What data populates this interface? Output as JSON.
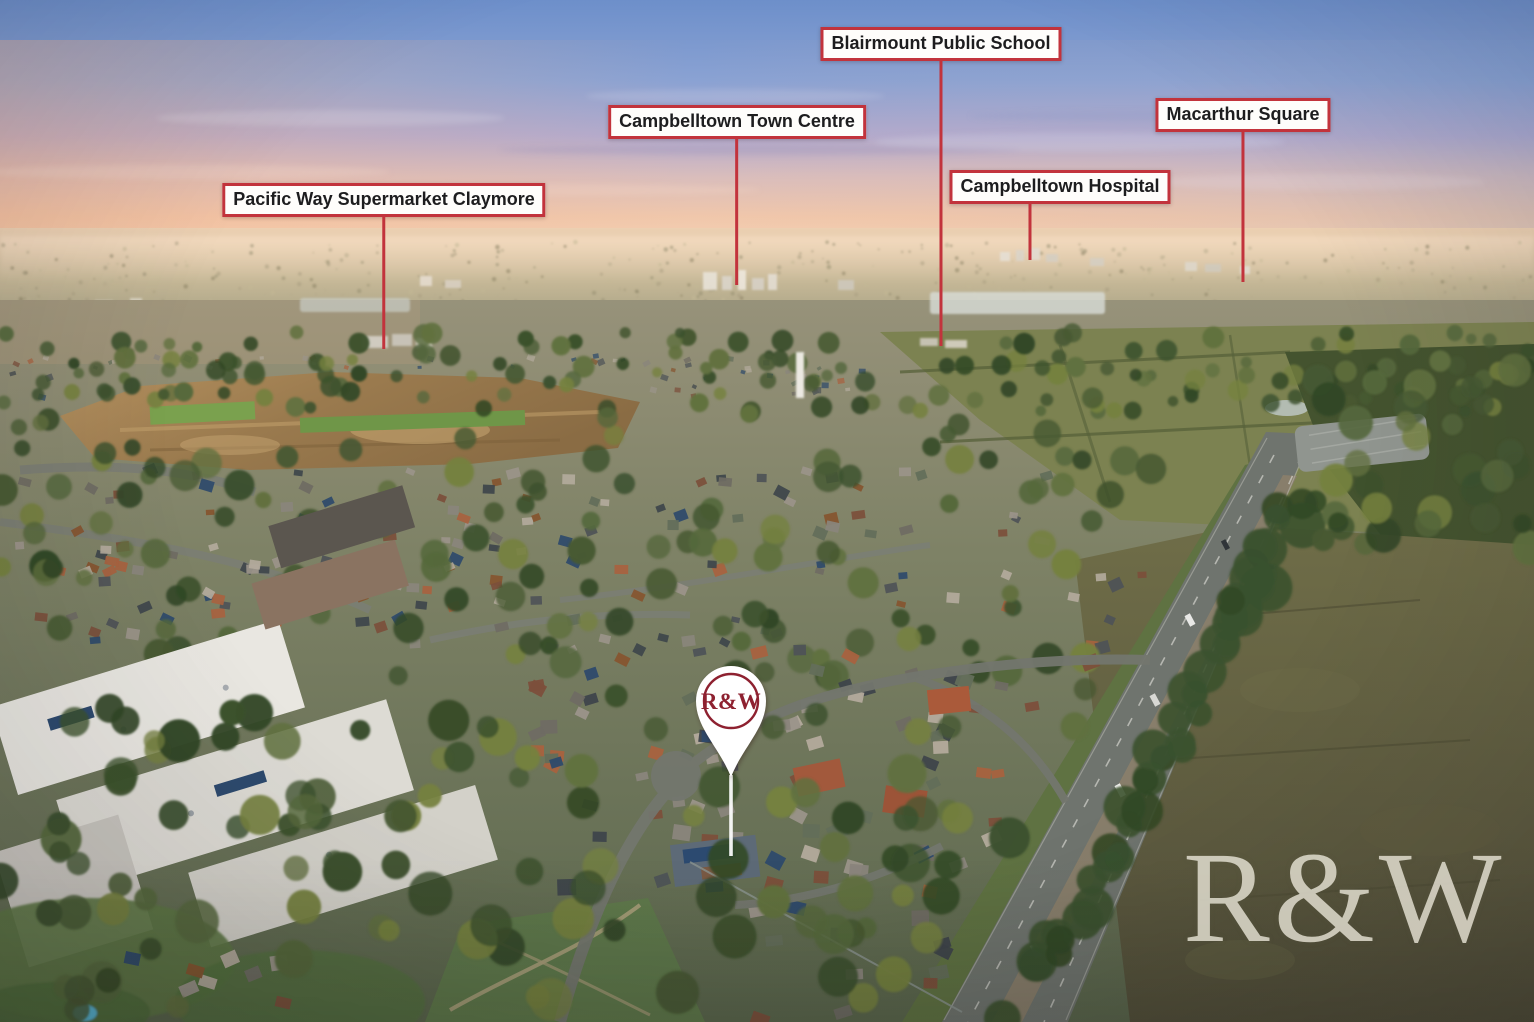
{
  "callouts": [
    {
      "id": "pacific-way-supermarket-claymore",
      "label": "Pacific Way Supermarket Claymore"
    },
    {
      "id": "campbelltown-town-centre",
      "label": "Campbelltown Town Centre"
    },
    {
      "id": "blairmount-public-school",
      "label": "Blairmount Public School"
    },
    {
      "id": "campbelltown-hospital",
      "label": "Campbelltown Hospital"
    },
    {
      "id": "macarthur-square",
      "label": "Macarthur Square"
    }
  ],
  "pin": {
    "logo_text": "R&W"
  },
  "watermark": {
    "text": "R&W"
  },
  "colors": {
    "callout_border": "#c2333c",
    "callout_bg": "#fefdfb",
    "callout_text": "#1d1d1f",
    "pin_body": "#ffffff",
    "pin_accent": "#8e2130",
    "watermark_text": "#eae6d8"
  }
}
